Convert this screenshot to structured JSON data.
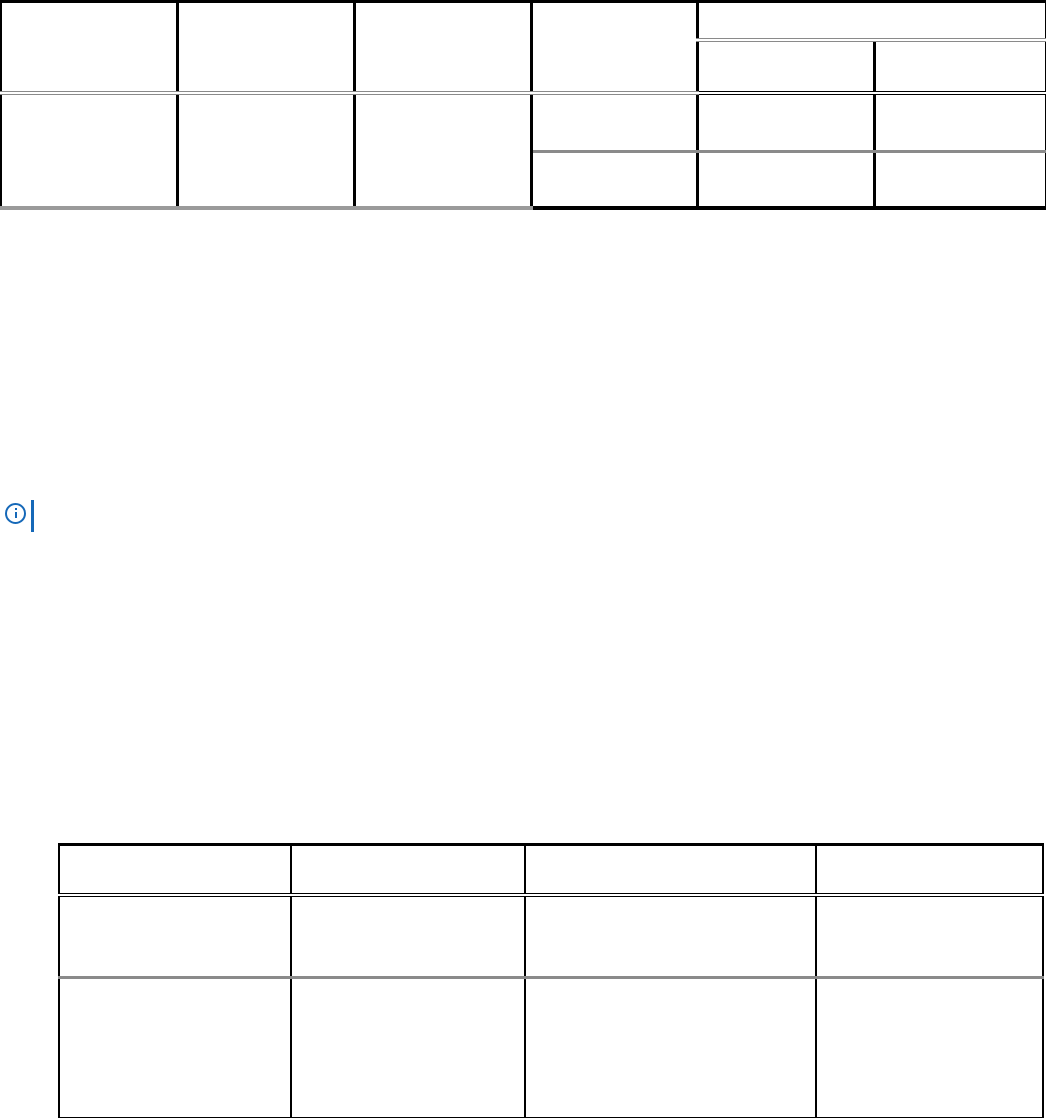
{
  "page": {
    "background": "#ffffff"
  },
  "colors": {
    "line_black": "#000000",
    "line_gray": "#8a8a8a",
    "line_gray2": "#9a9a9a",
    "note_blue": "#1568b8"
  },
  "top_table": {
    "description": "empty 6-column table fragment continued from previous page, right section has a spanned header over two sub-columns",
    "column_headers": [
      "",
      "",
      "",
      ""
    ],
    "span_header": "",
    "sub_headers": [
      "",
      ""
    ],
    "left_body_cells": [
      "",
      "",
      ""
    ],
    "body_rows": [
      [
        "",
        "",
        ""
      ],
      [
        "",
        "",
        ""
      ]
    ]
  },
  "note": {
    "icon": "info-icon",
    "text": ""
  },
  "bottom_table": {
    "description": "empty 4-column table with header row and two body rows, cut off at page bottom",
    "headers": [
      "",
      "",
      "",
      ""
    ],
    "rows": [
      [
        "",
        "",
        "",
        ""
      ],
      [
        "",
        "",
        "",
        ""
      ]
    ]
  }
}
